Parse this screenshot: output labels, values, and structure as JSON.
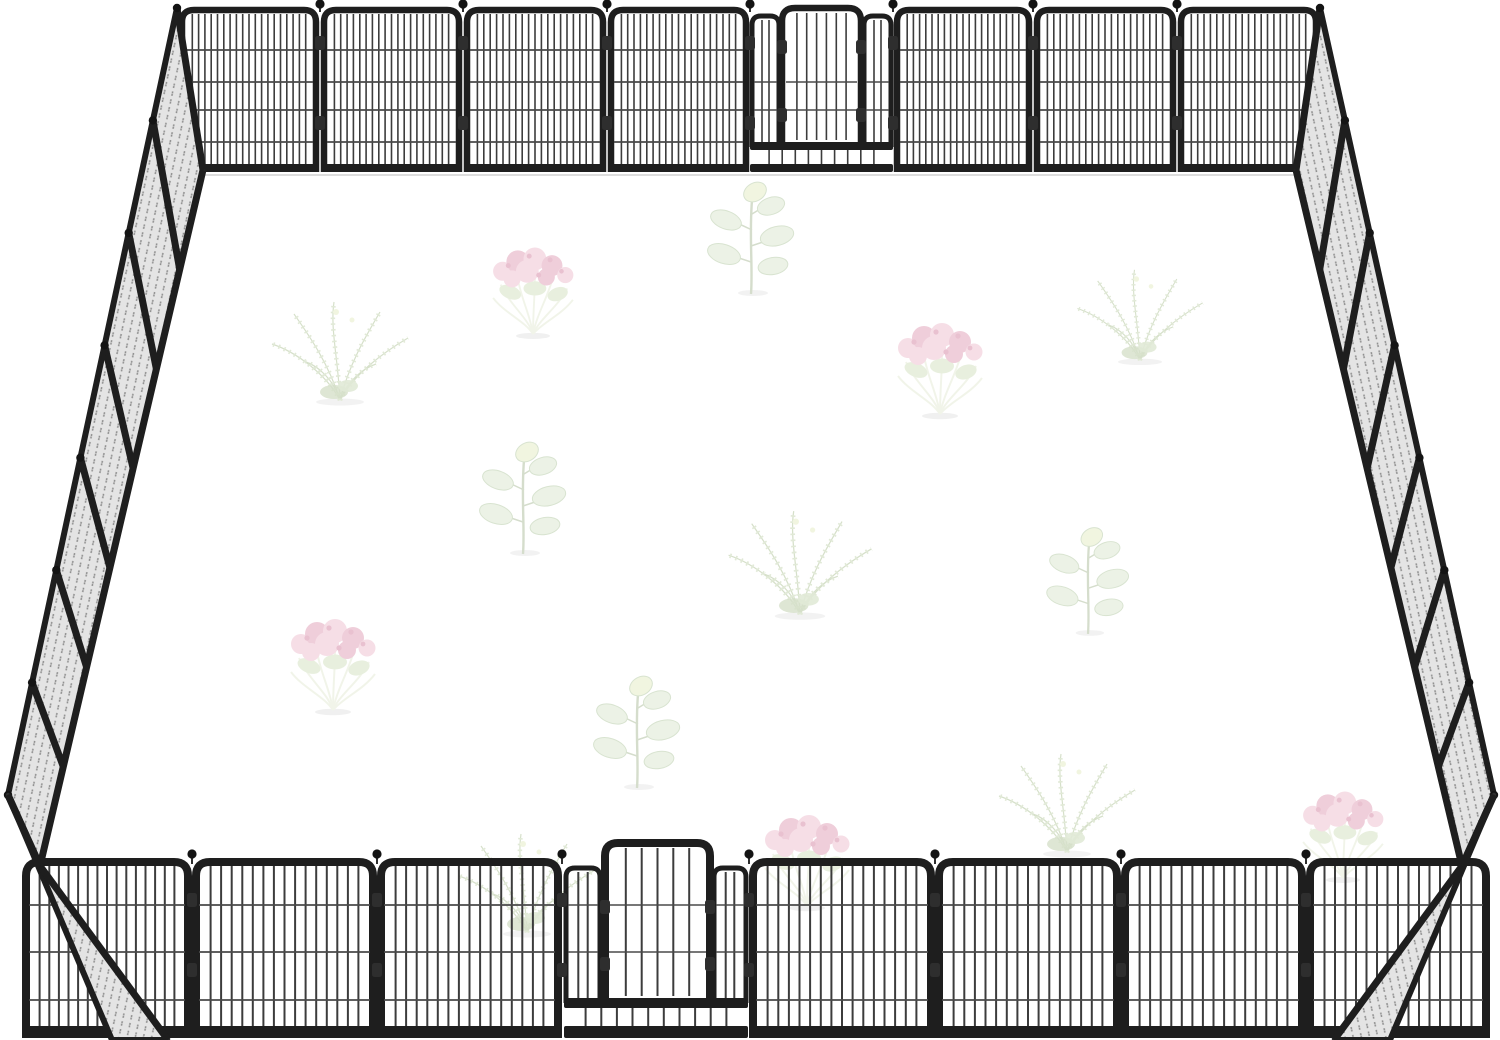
{
  "scene": {
    "label": "heavy-duty-metal-dog-playpen-enclosure-with-faint-plants",
    "canvas": {
      "width": 1500,
      "height": 1040
    },
    "colors": {
      "background": "#ffffff",
      "frame": "#1e1e1e",
      "frame_soft": "#2e2e2e",
      "bar": "#3c3c3c",
      "wire": "#4a4a4a",
      "mesh_fill": "#e4e4e4",
      "mesh_dot": "#8f8f8f",
      "ball": "#141414",
      "shadow_line": "#dddddd"
    }
  },
  "fence": {
    "center_x": 762,
    "back_wall": {
      "joints": [
        178,
        320,
        463,
        607,
        750,
        893,
        1033,
        1177,
        1320
      ],
      "top": 10,
      "bottom": 172,
      "gate_index": 4,
      "bars_per_panel": 20,
      "wire_ys": [
        50,
        82,
        110,
        142
      ],
      "corner_radius": 12,
      "lean": 0.045,
      "frame_w": 6.5,
      "bar_w": 1.6,
      "rail_h": 8,
      "ball_y": 4,
      "clamp_ys": [
        36,
        116
      ]
    },
    "front_wall": {
      "joints": [
        22,
        192,
        377,
        562,
        749,
        935,
        1121,
        1306,
        1490
      ],
      "top": 862,
      "bottom": 1038,
      "gate_index": 3,
      "bars_per_panel": 16,
      "wire_ys": [
        905,
        952,
        1000
      ],
      "corner_radius": 14,
      "lean": 0.05,
      "frame_w": 8,
      "bar_w": 2,
      "rail_h": 12,
      "ball_y": 854,
      "clamp_ys": [
        893,
        963
      ]
    },
    "back_gate": {
      "door": [
        782,
        861,
        8,
        142
      ],
      "door_bars": 7,
      "strips": [
        [
          752,
          779
        ],
        [
          864,
          891
        ]
      ],
      "strip_top": 16,
      "strip_bottom": 147,
      "mid_rail": [
        142,
        150
      ],
      "bottom_strip": [
        150,
        164
      ],
      "bottom_bars": 10,
      "bottom_rail": [
        164,
        172
      ],
      "wire_ys": [
        82,
        110
      ],
      "clamp_ys": [
        40,
        108
      ]
    },
    "front_gate": {
      "door": [
        605,
        710,
        843,
        998
      ],
      "door_bars": 6,
      "strips": [
        [
          566,
          600
        ],
        [
          714,
          746
        ]
      ],
      "strip_top": 868,
      "strip_bottom": 1003,
      "mid_rail": [
        998,
        1008
      ],
      "bottom_strip": [
        1008,
        1026
      ],
      "bottom_bars": 11,
      "bottom_rail": [
        1026,
        1038
      ],
      "wire_ys": [
        905,
        952
      ],
      "clamp_ys": [
        900,
        957
      ]
    },
    "left_wall": {
      "outer": [
        [
          177,
          8
        ],
        [
          8,
          795
        ],
        [
          112,
          1040
        ]
      ],
      "inner": [
        [
          203,
          170
        ],
        [
          40,
          866
        ],
        [
          168,
          1040
        ]
      ],
      "segments": 7,
      "hatch_angle": 102
    },
    "right_wall": {
      "outer": [
        [
          1320,
          8
        ],
        [
          1494,
          795
        ],
        [
          1390,
          1040
        ]
      ],
      "inner": [
        [
          1296,
          170
        ],
        [
          1462,
          866
        ],
        [
          1334,
          1040
        ]
      ],
      "segments": 7,
      "hatch_angle": 78
    }
  },
  "plants": {
    "opacity": 0.55,
    "colors": {
      "leaf_fill": "#dde8d2",
      "leaf_edge": "#b9cdaa",
      "leaf_hi": "#e6edc6",
      "stem": "#b2c2a2",
      "fern": "#c9d8b6",
      "fern_dark": "#b4c79f",
      "flower": "#eec3d2",
      "flower_dark": "#e2a6bc",
      "flower_dot": "#d78fa9",
      "flower_stem": "#e6ecd8",
      "flower_leaf": "#d5e2c3",
      "shadow": "#d8d8d8"
    },
    "items": [
      {
        "type": "seedling",
        "x": 751,
        "y": 292,
        "s": 1.0
      },
      {
        "type": "flower",
        "x": 533,
        "y": 334,
        "s": 0.95
      },
      {
        "type": "fern",
        "x": 340,
        "y": 400,
        "s": 1.0
      },
      {
        "type": "flower",
        "x": 940,
        "y": 414,
        "s": 1.0
      },
      {
        "type": "fern",
        "x": 1140,
        "y": 360,
        "s": 0.92
      },
      {
        "type": "seedling",
        "x": 523,
        "y": 552,
        "s": 1.0
      },
      {
        "type": "fern",
        "x": 800,
        "y": 614,
        "s": 1.05
      },
      {
        "type": "seedling",
        "x": 1088,
        "y": 632,
        "s": 0.95
      },
      {
        "type": "flower",
        "x": 333,
        "y": 710,
        "s": 1.0
      },
      {
        "type": "seedling",
        "x": 637,
        "y": 786,
        "s": 1.0
      },
      {
        "type": "fern",
        "x": 1067,
        "y": 852,
        "s": 1.0
      },
      {
        "type": "flower",
        "x": 807,
        "y": 906,
        "s": 1.0
      },
      {
        "type": "fern",
        "x": 527,
        "y": 932,
        "s": 1.0
      },
      {
        "type": "flower",
        "x": 1343,
        "y": 878,
        "s": 0.95
      }
    ]
  }
}
